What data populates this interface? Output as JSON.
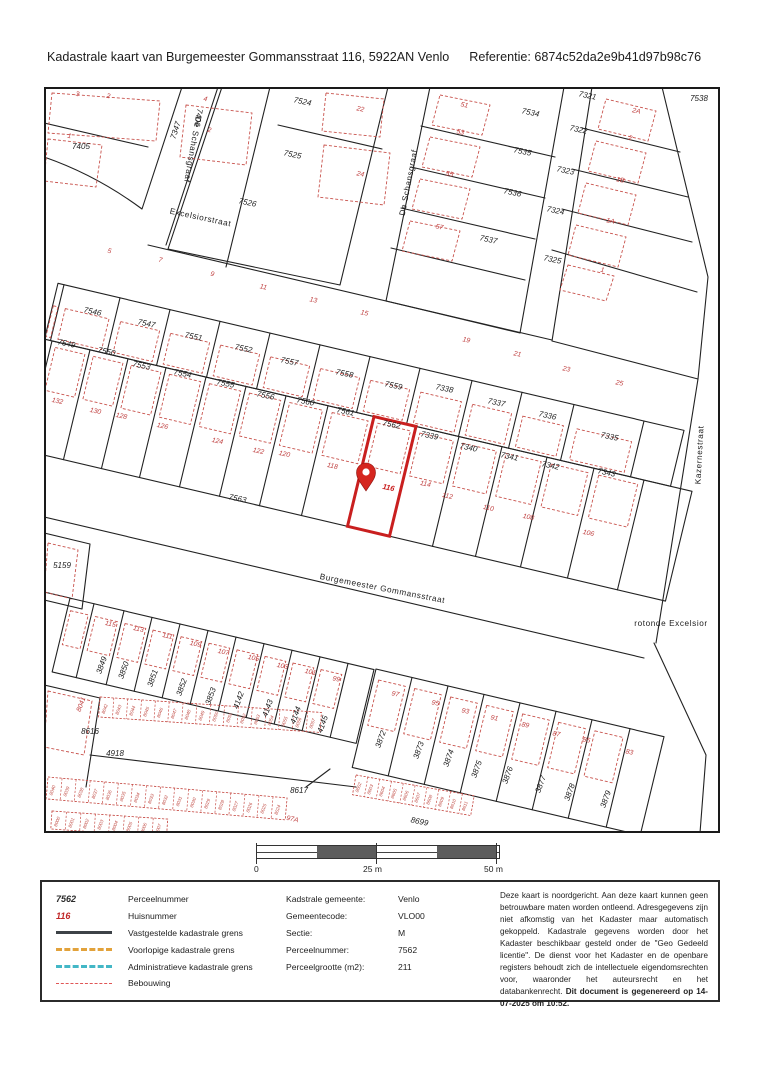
{
  "header": {
    "title": "Kadastrale kaart van Burgemeester Gommansstraat 116, 5922AN Venlo",
    "reference": "Referentie: 6874c52da2e9b41d97b98c76"
  },
  "map": {
    "colors": {
      "parcel_line": "#222222",
      "building": "#c8524c",
      "selected": "#c91f1f",
      "house_number": "#bf3d3d"
    },
    "labels": [
      {
        "t": "De Schansgraaf",
        "x": 146,
        "y": 62,
        "r": 100,
        "c": "s"
      },
      {
        "t": "De Schansgraaf",
        "x": 367,
        "y": 96,
        "r": -79,
        "c": "s"
      },
      {
        "t": "Excelsiorstraat",
        "x": 156,
        "y": 133,
        "r": 12,
        "c": "s"
      },
      {
        "t": "Burgemeester Gommansstraat",
        "x": 338,
        "y": 504,
        "r": 11,
        "c": "s"
      },
      {
        "t": "Kazernestraat",
        "x": 658,
        "y": 368,
        "r": -87,
        "c": "s"
      },
      {
        "t": "rotonde Excelsior",
        "x": 627,
        "y": 539,
        "r": 0,
        "c": "s"
      },
      {
        "t": "7405",
        "x": 37,
        "y": 62,
        "r": 0,
        "c": "p"
      },
      {
        "t": "7406",
        "x": 152,
        "y": 30,
        "r": 100,
        "c": "p"
      },
      {
        "t": "7347",
        "x": 134,
        "y": 44,
        "r": -72,
        "c": "p"
      },
      {
        "t": "7524",
        "x": 258,
        "y": 17,
        "c": "p"
      },
      {
        "t": "7525",
        "x": 248,
        "y": 70,
        "c": "p"
      },
      {
        "t": "7526",
        "x": 203,
        "y": 118,
        "c": "p"
      },
      {
        "t": "7534",
        "x": 486,
        "y": 28,
        "c": "p"
      },
      {
        "t": "7535",
        "x": 478,
        "y": 67,
        "c": "p"
      },
      {
        "t": "7536",
        "x": 468,
        "y": 108,
        "c": "p"
      },
      {
        "t": "7537",
        "x": 444,
        "y": 155,
        "c": "p"
      },
      {
        "t": "7321",
        "x": 543,
        "y": 11,
        "c": "p"
      },
      {
        "t": "7322",
        "x": 534,
        "y": 45,
        "c": "p"
      },
      {
        "t": "7323",
        "x": 521,
        "y": 86,
        "c": "p"
      },
      {
        "t": "7324",
        "x": 511,
        "y": 126,
        "c": "p"
      },
      {
        "t": "7325",
        "x": 508,
        "y": 175,
        "c": "p"
      },
      {
        "t": "7538",
        "x": 655,
        "y": 14,
        "r": 0,
        "c": "p"
      },
      {
        "t": "7546",
        "x": 48,
        "y": 227,
        "c": "p"
      },
      {
        "t": "7547",
        "x": 102,
        "y": 239,
        "c": "p"
      },
      {
        "t": "7551",
        "x": 149,
        "y": 252,
        "c": "p"
      },
      {
        "t": "7552",
        "x": 199,
        "y": 264,
        "c": "p"
      },
      {
        "t": "7557",
        "x": 245,
        "y": 277,
        "c": "p"
      },
      {
        "t": "7558",
        "x": 300,
        "y": 289,
        "c": "p"
      },
      {
        "t": "7559",
        "x": 349,
        "y": 301,
        "c": "p"
      },
      {
        "t": "7338",
        "x": 400,
        "y": 304,
        "c": "p"
      },
      {
        "t": "7337",
        "x": 452,
        "y": 318,
        "c": "p"
      },
      {
        "t": "7336",
        "x": 503,
        "y": 331,
        "c": "p"
      },
      {
        "t": "7335",
        "x": 565,
        "y": 352,
        "c": "p"
      },
      {
        "t": "7549",
        "x": 22,
        "y": 259,
        "c": "p"
      },
      {
        "t": "7550",
        "x": 62,
        "y": 267,
        "c": "p"
      },
      {
        "t": "7553",
        "x": 97,
        "y": 281,
        "c": "p"
      },
      {
        "t": "7554",
        "x": 138,
        "y": 289,
        "c": "p"
      },
      {
        "t": "7555",
        "x": 181,
        "y": 299,
        "c": "p"
      },
      {
        "t": "7556",
        "x": 221,
        "y": 311,
        "c": "p"
      },
      {
        "t": "7560",
        "x": 261,
        "y": 317,
        "c": "p"
      },
      {
        "t": "7561",
        "x": 301,
        "y": 327,
        "c": "p"
      },
      {
        "t": "7562",
        "x": 347,
        "y": 340,
        "c": "p"
      },
      {
        "t": "7339",
        "x": 385,
        "y": 351,
        "c": "p"
      },
      {
        "t": "7340",
        "x": 424,
        "y": 363,
        "c": "p"
      },
      {
        "t": "7341",
        "x": 465,
        "y": 372,
        "c": "p"
      },
      {
        "t": "7342",
        "x": 506,
        "y": 381,
        "c": "p"
      },
      {
        "t": "7343",
        "x": 562,
        "y": 388,
        "c": "p"
      },
      {
        "t": "7563",
        "x": 193,
        "y": 414,
        "c": "p"
      },
      {
        "t": "5159",
        "x": 18,
        "y": 481,
        "r": 0,
        "c": "p"
      },
      {
        "t": "3849",
        "x": 60,
        "y": 579,
        "r": -70,
        "c": "p"
      },
      {
        "t": "3850",
        "x": 82,
        "y": 584,
        "r": -70,
        "c": "p"
      },
      {
        "t": "3851",
        "x": 111,
        "y": 592,
        "r": -70,
        "c": "p"
      },
      {
        "t": "3852",
        "x": 140,
        "y": 601,
        "r": -70,
        "c": "p"
      },
      {
        "t": "3853",
        "x": 169,
        "y": 610,
        "r": -70,
        "c": "p"
      },
      {
        "t": "4142",
        "x": 197,
        "y": 614,
        "r": -70,
        "c": "p"
      },
      {
        "t": "4143",
        "x": 226,
        "y": 622,
        "r": -70,
        "c": "p"
      },
      {
        "t": "4144",
        "x": 254,
        "y": 629,
        "r": -70,
        "c": "p"
      },
      {
        "t": "4145",
        "x": 281,
        "y": 638,
        "r": -70,
        "c": "p"
      },
      {
        "t": "8616",
        "x": 46,
        "y": 647,
        "r": 0,
        "c": "p"
      },
      {
        "t": "4918",
        "x": 71,
        "y": 669,
        "r": 0,
        "c": "p"
      },
      {
        "t": "8617",
        "x": 255,
        "y": 706,
        "r": 0,
        "c": "p"
      },
      {
        "t": "8699",
        "x": 375,
        "y": 737,
        "c": "p"
      },
      {
        "t": "3872",
        "x": 339,
        "y": 653,
        "r": -70,
        "c": "p"
      },
      {
        "t": "3873",
        "x": 377,
        "y": 664,
        "r": -70,
        "c": "p"
      },
      {
        "t": "3874",
        "x": 407,
        "y": 672,
        "r": -70,
        "c": "p"
      },
      {
        "t": "3875",
        "x": 435,
        "y": 683,
        "r": -70,
        "c": "p"
      },
      {
        "t": "3876",
        "x": 466,
        "y": 689,
        "r": -70,
        "c": "p"
      },
      {
        "t": "3877",
        "x": 499,
        "y": 698,
        "r": -70,
        "c": "p"
      },
      {
        "t": "3878",
        "x": 528,
        "y": 706,
        "r": -70,
        "c": "p"
      },
      {
        "t": "3879",
        "x": 564,
        "y": 713,
        "r": -70,
        "c": "p"
      },
      {
        "t": "3",
        "x": 33,
        "y": 9,
        "c": "h"
      },
      {
        "t": "2",
        "x": 64,
        "y": 11,
        "c": "h"
      },
      {
        "t": "1",
        "x": 25,
        "y": 51,
        "c": "h"
      },
      {
        "t": "4",
        "x": 161,
        "y": 14,
        "c": "h"
      },
      {
        "t": "2",
        "x": 165,
        "y": 45,
        "c": "h"
      },
      {
        "t": "22",
        "x": 316,
        "y": 24,
        "c": "h"
      },
      {
        "t": "24",
        "x": 316,
        "y": 89,
        "c": "h"
      },
      {
        "t": "51",
        "x": 420,
        "y": 20,
        "c": "h"
      },
      {
        "t": "53",
        "x": 416,
        "y": 47,
        "c": "h"
      },
      {
        "t": "55",
        "x": 405,
        "y": 89,
        "c": "h"
      },
      {
        "t": "57",
        "x": 395,
        "y": 142,
        "c": "h"
      },
      {
        "t": "2A",
        "x": 592,
        "y": 26,
        "c": "h"
      },
      {
        "t": "2",
        "x": 586,
        "y": 53,
        "c": "h"
      },
      {
        "t": "1B",
        "x": 576,
        "y": 95,
        "c": "h"
      },
      {
        "t": "1A",
        "x": 566,
        "y": 136,
        "c": "h"
      },
      {
        "t": "1",
        "x": 558,
        "y": 185,
        "c": "h"
      },
      {
        "t": "5",
        "x": 65,
        "y": 166,
        "c": "h"
      },
      {
        "t": "7",
        "x": 116,
        "y": 175,
        "c": "h"
      },
      {
        "t": "9",
        "x": 168,
        "y": 189,
        "c": "h"
      },
      {
        "t": "11",
        "x": 219,
        "y": 202,
        "c": "h"
      },
      {
        "t": "13",
        "x": 269,
        "y": 215,
        "c": "h"
      },
      {
        "t": "15",
        "x": 320,
        "y": 228,
        "c": "h"
      },
      {
        "t": "19",
        "x": 422,
        "y": 255,
        "c": "h"
      },
      {
        "t": "21",
        "x": 473,
        "y": 269,
        "c": "h"
      },
      {
        "t": "23",
        "x": 522,
        "y": 284,
        "c": "h"
      },
      {
        "t": "25",
        "x": 575,
        "y": 298,
        "c": "h"
      },
      {
        "t": "132",
        "x": 13,
        "y": 316,
        "c": "h"
      },
      {
        "t": "130",
        "x": 51,
        "y": 326,
        "c": "h"
      },
      {
        "t": "128",
        "x": 77,
        "y": 331,
        "c": "h"
      },
      {
        "t": "126",
        "x": 118,
        "y": 341,
        "c": "h"
      },
      {
        "t": "124",
        "x": 173,
        "y": 356,
        "c": "h"
      },
      {
        "t": "122",
        "x": 214,
        "y": 366,
        "c": "h"
      },
      {
        "t": "120",
        "x": 240,
        "y": 369,
        "c": "h"
      },
      {
        "t": "118",
        "x": 288,
        "y": 381,
        "c": "h"
      },
      {
        "t": "116",
        "x": 344,
        "y": 403,
        "c": "hs"
      },
      {
        "t": "114",
        "x": 381,
        "y": 399,
        "c": "h"
      },
      {
        "t": "112",
        "x": 403,
        "y": 411,
        "c": "h"
      },
      {
        "t": "110",
        "x": 444,
        "y": 423,
        "c": "h"
      },
      {
        "t": "108",
        "x": 484,
        "y": 432,
        "c": "h"
      },
      {
        "t": "106",
        "x": 544,
        "y": 448,
        "c": "h"
      },
      {
        "t": "115",
        "x": 66,
        "y": 539,
        "c": "h"
      },
      {
        "t": "113",
        "x": 94,
        "y": 544,
        "c": "h"
      },
      {
        "t": "111",
        "x": 123,
        "y": 551,
        "c": "h"
      },
      {
        "t": "109",
        "x": 151,
        "y": 559,
        "c": "h"
      },
      {
        "t": "107",
        "x": 179,
        "y": 567,
        "c": "h"
      },
      {
        "t": "105",
        "x": 209,
        "y": 573,
        "c": "h"
      },
      {
        "t": "103",
        "x": 238,
        "y": 581,
        "c": "h"
      },
      {
        "t": "101",
        "x": 266,
        "y": 587,
        "c": "h"
      },
      {
        "t": "99",
        "x": 292,
        "y": 594,
        "c": "h"
      },
      {
        "t": "97",
        "x": 351,
        "y": 609,
        "c": "h"
      },
      {
        "t": "95",
        "x": 391,
        "y": 618,
        "c": "h"
      },
      {
        "t": "93",
        "x": 421,
        "y": 626,
        "c": "h"
      },
      {
        "t": "91",
        "x": 450,
        "y": 633,
        "c": "h"
      },
      {
        "t": "89",
        "x": 481,
        "y": 640,
        "c": "h"
      },
      {
        "t": "87",
        "x": 512,
        "y": 649,
        "c": "h"
      },
      {
        "t": "85",
        "x": 542,
        "y": 655,
        "c": "h"
      },
      {
        "t": "83",
        "x": 585,
        "y": 667,
        "c": "h"
      },
      {
        "t": "97A",
        "x": 248,
        "y": 734,
        "c": "h"
      },
      {
        "t": "8041",
        "x": 39,
        "y": 618,
        "r": -70,
        "c": "h"
      }
    ],
    "garage_strips": [
      {
        "numbers": [
          "8042",
          "8043",
          "8044",
          "8045",
          "8046",
          "8047",
          "8048",
          "8049",
          "8050",
          "8051",
          "8052",
          "8053",
          "8054",
          "8055",
          "8056",
          "8057"
        ]
      },
      {
        "numbers": [
          "8040",
          "8039",
          "8038",
          "8037",
          "8036",
          "8035",
          "8034",
          "8033",
          "8032",
          "8031",
          "8030",
          "8029",
          "8028",
          "8027",
          "8026",
          "8025",
          "8024"
        ]
      },
      {
        "numbers": [
          "8000",
          "8001",
          "8002",
          "8003",
          "8004",
          "8005",
          "8006",
          "8007"
        ]
      },
      {
        "numbers": [
          "8602",
          "8603",
          "8604",
          "8605",
          "8606",
          "8607",
          "8608",
          "8609",
          "8610",
          "8611"
        ]
      }
    ]
  },
  "scalebar": {
    "labels": [
      "0",
      "25 m",
      "50 m"
    ]
  },
  "legend": {
    "parcel_example": "7562",
    "parcel_label": "Perceelnummer",
    "house_example": "116",
    "house_label": "Huisnummer",
    "lines": [
      {
        "style": "solid-dark",
        "label": "Vastgestelde kadastrale grens"
      },
      {
        "style": "dash-orange",
        "label": "Voorlopige kadastrale grens"
      },
      {
        "style": "dash-teal",
        "label": "Administratieve kadastrale grens"
      },
      {
        "style": "dash-red",
        "label": "Bebouwing"
      }
    ]
  },
  "info": {
    "rows": [
      {
        "label": "Kadstrale gemeente:",
        "value": "Venlo"
      },
      {
        "label": "Gemeentecode:",
        "value": "VLO00"
      },
      {
        "label": "Sectie:",
        "value": "M"
      },
      {
        "label": "Perceelnummer:",
        "value": "7562"
      },
      {
        "label": "Perceelgrootte (m2):",
        "value": "211"
      }
    ]
  },
  "disclaimer": {
    "text": "Deze kaart is noordgericht. Aan deze kaart kunnen geen betrouwbare maten worden ontleend. Adresgegevens zijn niet afkomstig van het Kadaster maar automatisch gekoppeld. Kadastrale gegevens worden door het Kadaster beschikbaar gesteld onder de \"Geo Gedeeld licentie\". De dienst voor het Kadaster en de openbare registers behoudt zich de intellectuele eigendomsrechten voor, waaronder het auteursrecht en het databankenrecht.",
    "bold": "Dit document is gegenereerd op 14-07-2025 om 10:52."
  }
}
